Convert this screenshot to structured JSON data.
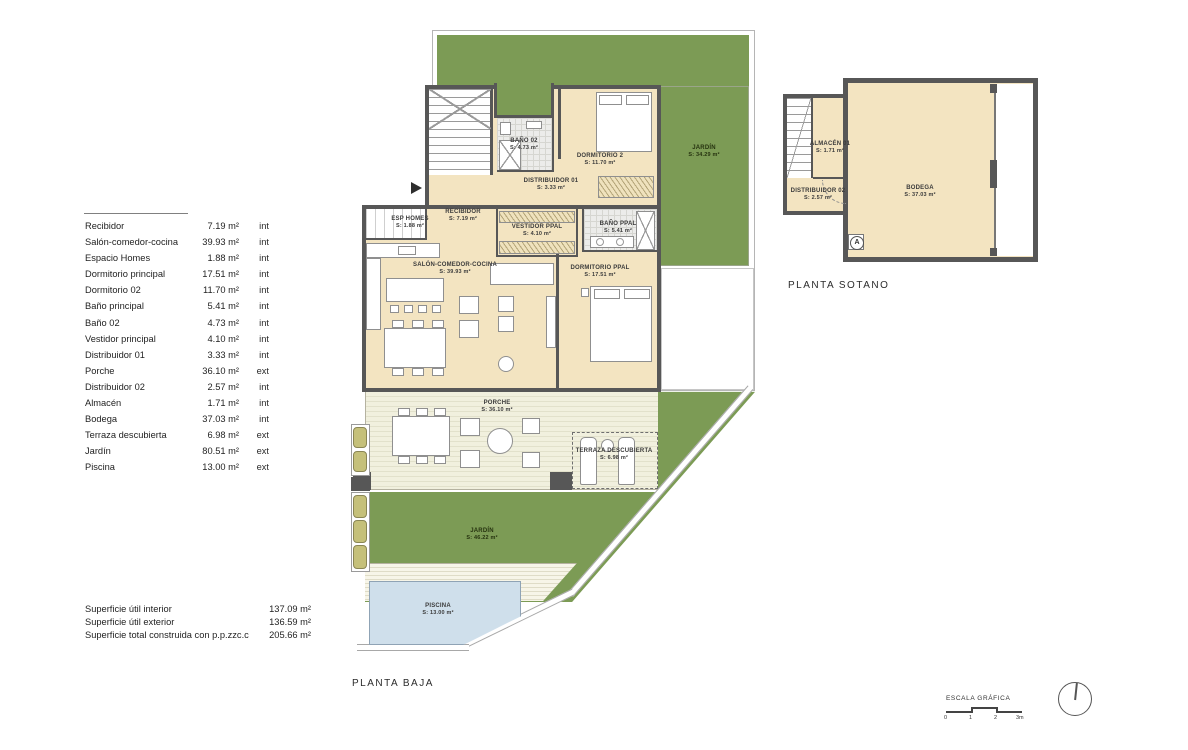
{
  "legend": {
    "rows": [
      {
        "name": "Recibidor",
        "area": "7.19 m²",
        "type": "int"
      },
      {
        "name": "Salón-comedor-cocina",
        "area": "39.93 m²",
        "type": "int"
      },
      {
        "name": "Espacio Homes",
        "area": "1.88 m²",
        "type": "int"
      },
      {
        "name": "Dormitorio principal",
        "area": "17.51 m²",
        "type": "int"
      },
      {
        "name": "Dormitorio 02",
        "area": "11.70 m²",
        "type": "int"
      },
      {
        "name": "Baño principal",
        "area": "5.41 m²",
        "type": "int"
      },
      {
        "name": "Baño 02",
        "area": "4.73 m²",
        "type": "int"
      },
      {
        "name": "Vestidor principal",
        "area": "4.10 m²",
        "type": "int"
      },
      {
        "name": "Distribuidor 01",
        "area": "3.33 m²",
        "type": "int"
      },
      {
        "name": "Porche",
        "area": "36.10 m²",
        "type": "ext"
      },
      {
        "name": "Distribuidor 02",
        "area": "2.57 m²",
        "type": "int"
      },
      {
        "name": "Almacén",
        "area": "1.71 m²",
        "type": "int"
      },
      {
        "name": "Bodega",
        "area": "37.03 m²",
        "type": "int"
      },
      {
        "name": "Terraza descubierta",
        "area": "6.98 m²",
        "type": "ext"
      },
      {
        "name": "Jardín",
        "area": "80.51 m²",
        "type": "ext"
      },
      {
        "name": "Piscina",
        "area": "13.00 m²",
        "type": "ext"
      }
    ]
  },
  "totals": {
    "rows": [
      {
        "label": "Superficie útil interior",
        "value": "137.09 m²"
      },
      {
        "label": "Superficie útil exterior",
        "value": "136.59 m²"
      },
      {
        "label": "Superficie total construida con p.p.zzc.c",
        "value": "205.66 m²"
      }
    ]
  },
  "baja": {
    "title": "PLANTA BAJA",
    "labels": {
      "bano02": {
        "name": "BAÑO 02",
        "area": "S: 4.73 m²"
      },
      "dorm2": {
        "name": "DORMITORIO 2",
        "area": "S: 11.70 m²"
      },
      "distribuidor01": {
        "name": "DISTRIBUIDOR 01",
        "area": "S: 3.33 m²"
      },
      "recibidor": {
        "name": "RECIBIDOR",
        "area": "S: 7.19 m²"
      },
      "espHomes": {
        "name": "ESP HOMES",
        "area": "S: 1.88 m²"
      },
      "vestidor": {
        "name": "VESTIDOR PPAL",
        "area": "S: 4.10 m²"
      },
      "banoPpal": {
        "name": "BAÑO PPAL",
        "area": "S: 5.41 m²"
      },
      "salon": {
        "name": "SALÓN-COMEDOR-COCINA",
        "area": "S: 39.93 m²"
      },
      "dormPpal": {
        "name": "DORMITORIO PPAL",
        "area": "S: 17.51 m²"
      },
      "porche": {
        "name": "PORCHE",
        "area": "S: 36.10 m²"
      },
      "terraza": {
        "name": "TERRAZA DESCUBIERTA",
        "area": "S: 6.98 m²"
      },
      "jardinTop": {
        "name": "JARDÍN",
        "area": "S: 34.29 m²"
      },
      "jardinBottom": {
        "name": "JARDÍN",
        "area": "S: 46.22 m²"
      },
      "piscina": {
        "name": "PISCINA",
        "area": "S: 13.00 m²"
      }
    }
  },
  "sotano": {
    "title": "PLANTA SOTANO",
    "marker": "A",
    "labels": {
      "almacen": {
        "name": "ALMACÉN 01",
        "area": "S: 1.71 m²"
      },
      "distribuidor02": {
        "name": "DISTRIBUIDOR 02",
        "area": "S: 2.57 m²"
      },
      "bodega": {
        "name": "BODEGA",
        "area": "S: 37.03 m²"
      }
    }
  },
  "scale": {
    "title": "ESCALA GRÁFICA",
    "ticks": [
      "0",
      "1",
      "2",
      "3m"
    ]
  },
  "colors": {
    "wall": "#575757",
    "floor": "#f3e4c1",
    "garden": "#7c9b55",
    "pool": "#cfdfeb",
    "porch": "#f1f0de",
    "planter": "#c5c07a"
  }
}
